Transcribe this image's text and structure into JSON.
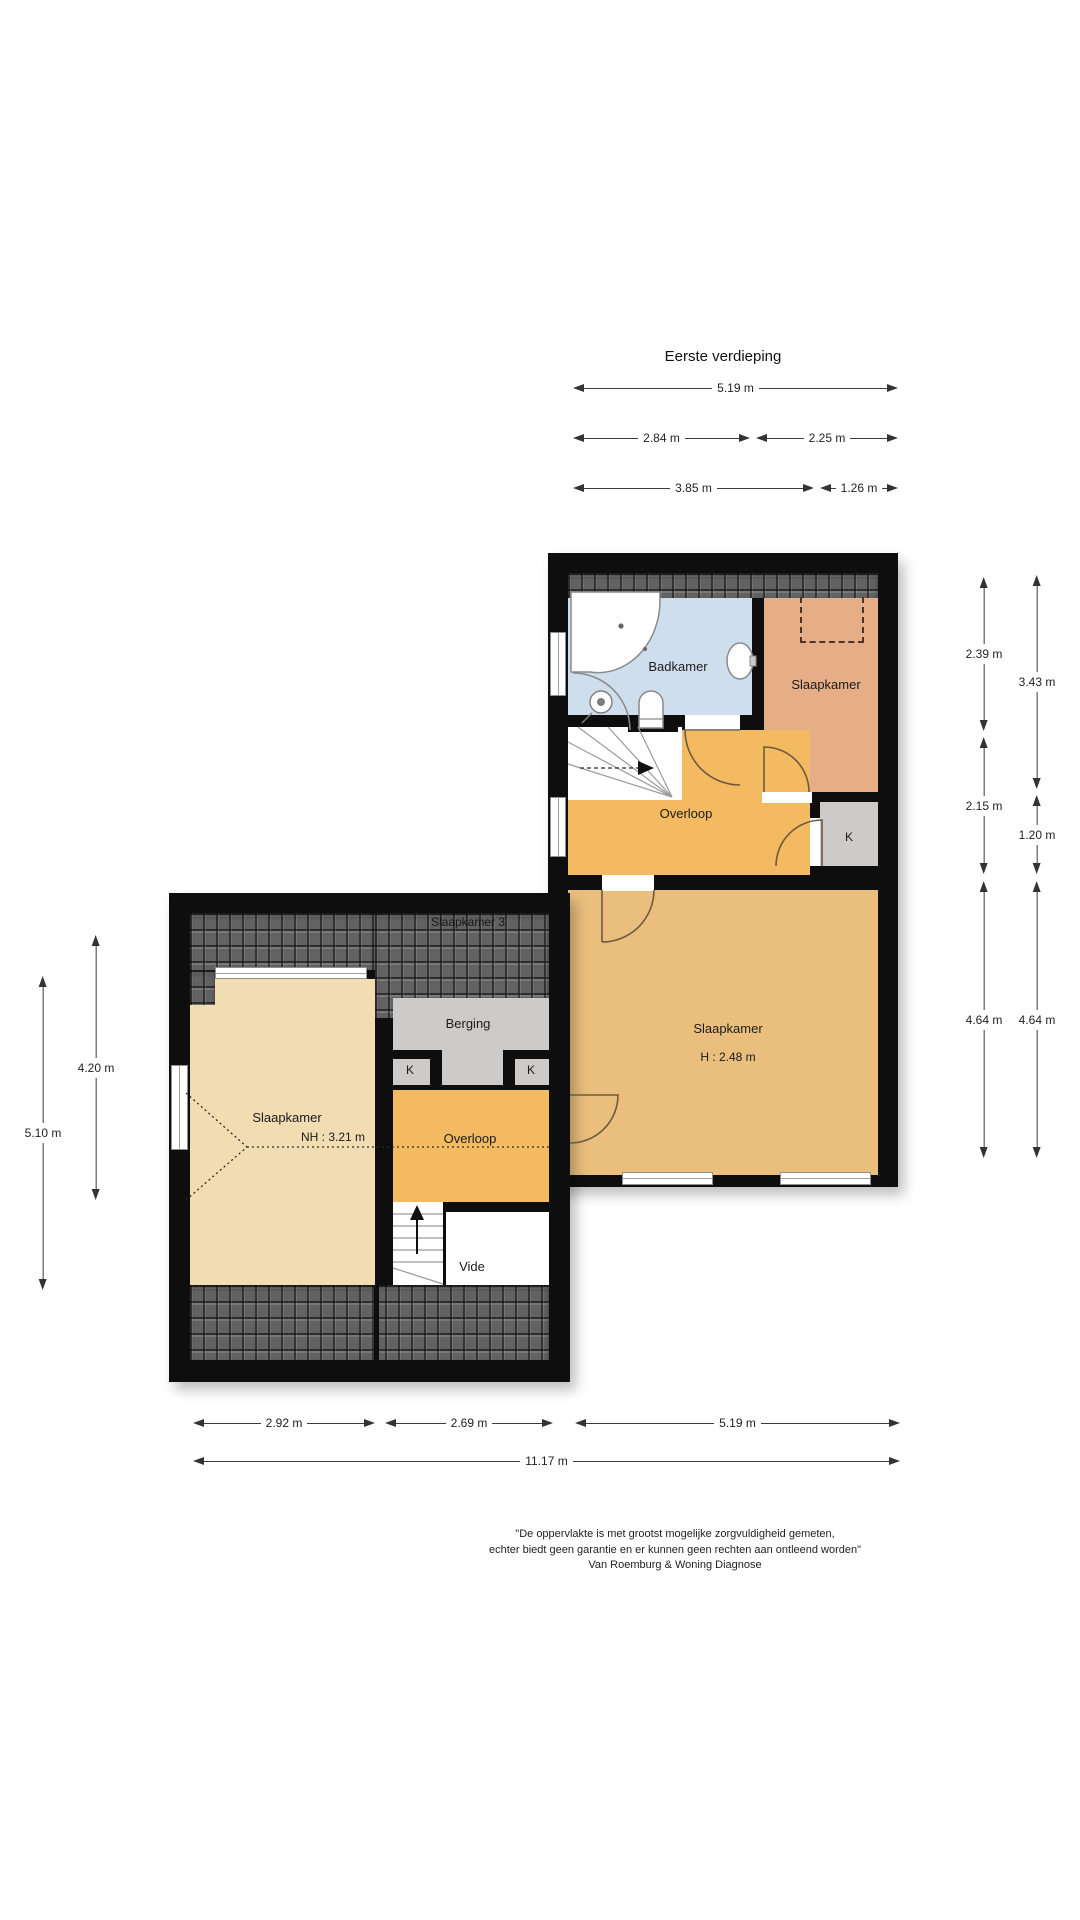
{
  "title": "Eerste verdieping",
  "floorplan": {
    "right_wing": {
      "badkamer_label": "Badkamer",
      "slaapkamer_top_label": "Slaapkamer",
      "overloop_label": "Overloop",
      "closet_label": "K",
      "slaapkamer_main_label": "Slaapkamer",
      "slaapkamer_main_height": "H : 2.48 m"
    },
    "left_wing": {
      "roof_room_label": "Slaapkamer 3",
      "berging_label": "Berging",
      "closet_left_label": "K",
      "closet_right_label": "K",
      "slaapkamer_label": "Slaapkamer",
      "ridge_height_label": "NH : 3.21 m",
      "overloop_label": "Overloop",
      "vide_label": "Vide"
    }
  },
  "dimensions": {
    "top": {
      "total": "5.19 m",
      "row2": [
        "2.84 m",
        "2.25 m"
      ],
      "row3": [
        "3.85 m",
        "1.26 m"
      ]
    },
    "right": {
      "col1": [
        "2.39 m",
        "2.15 m",
        "4.64 m"
      ],
      "col2": [
        "3.43 m",
        "1.20 m",
        "4.64 m"
      ]
    },
    "left": {
      "outer": "5.10 m",
      "inner": "4.20 m"
    },
    "bottom": {
      "row1": [
        "2.92 m",
        "2.69 m",
        "5.19 m"
      ],
      "total": "11.17 m"
    }
  },
  "footer": {
    "line1": "\"De oppervlakte is met grootst mogelijke zorgvuldigheid gemeten,",
    "line2": "echter biedt geen garantie en er kunnen geen rechten aan ontleend worden\"",
    "line3": "Van Roemburg & Woning Diagnose"
  },
  "colors": {
    "wall": "#0e0e0e",
    "badkamer": "#cfdeed",
    "slaapkamer_top": "#e6ae86",
    "overloop": "#f3ba61",
    "slaapkamer_main": "#eabf7d",
    "slaapkamer_left": "#f2dcb2",
    "storage_gray": "#cccbca",
    "roof_tiles": "#626262"
  }
}
